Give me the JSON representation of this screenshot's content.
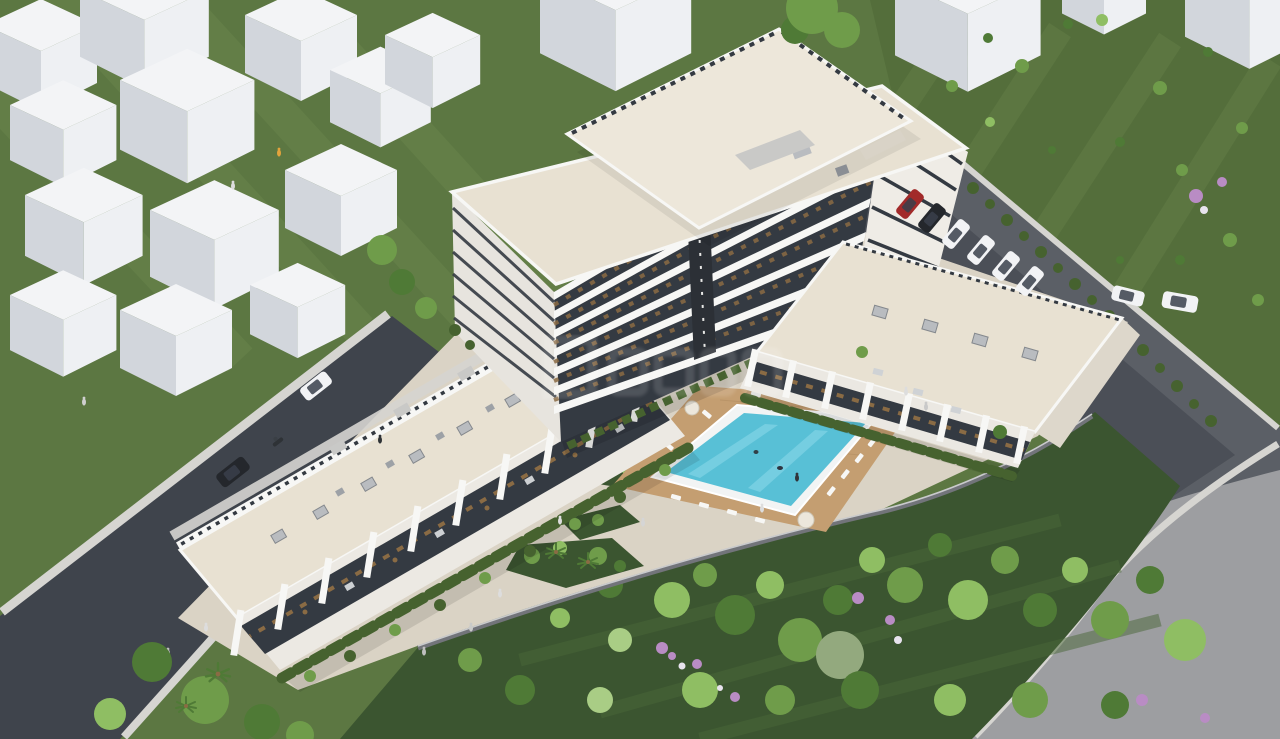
{
  "page": {
    "title": "Aerial 3D architectural rendering of a residential complex"
  },
  "palette": {
    "grass": "#5C7742",
    "grassStripe": "#6E8A50",
    "field": "#546E3B",
    "fieldStripe": "#67814A",
    "garden": "#3B5530",
    "gardenRow": "#4A6838",
    "treeA": "#4F7A36",
    "treeB": "#6F9C4A",
    "treeC": "#8FBE63",
    "treeD": "#A9CD85",
    "treeSage": "#93A97E",
    "hedge": "#46622F",
    "roadDark": "#3F444C",
    "roadMid": "#5B5F66",
    "roadLight": "#9D9EA1",
    "parking": "#4B4F57",
    "sidewalk": "#D6D5D1",
    "plaza": "#DAD3C5",
    "pathLight": "#E6E3DA",
    "roofBeige": "#E8E1D2",
    "canopy": "#EDE7DA",
    "white": "#F7F7F5",
    "facadeLight": "#EFECE6",
    "facadeSide": "#E7E4DE",
    "glass": "#343A42",
    "wood": "#8A6B44",
    "deck": "#C49E71",
    "water": "#58C0D6",
    "waterLight": "#8EDAEA",
    "rim": "#F2F4F4",
    "wallGray": "#72747A",
    "purple": "#B98CC4",
    "flowerWhite": "#E8E3EE",
    "skylight": "#B9BCC0",
    "cubeTop": "#F3F4F6",
    "cubeLeft": "#D2D6DC",
    "cubeRight": "#EEF0F3",
    "carRed": "#A22A2A",
    "carDark": "#24272C",
    "carWhite": "#F2F3F5",
    "figure": "#DADADA",
    "figureOrange": "#E2A33C"
  },
  "labels": {
    "scene": "Aerial render: apartment tower with terraced units, pool and garden",
    "lawn": "Lawn with white massing blocks",
    "context_blocks": "White context massing blocks",
    "field": "Grass field with shrubs",
    "left_road": "Asphalt street (left)",
    "right_road": "Perimeter road (right)",
    "parking": "Parking area behind buildings",
    "plaza": "Paved courtyard and walkways",
    "garden": "Landscaped garden with trees",
    "pool": "Swimming pool",
    "pool_deck": "Wooden pool deck with sun loungers",
    "terraced_row": "Terraced row of units with roof deck",
    "main_tower": "Main apartment tower",
    "rooftop_canopy": "Rooftop canopy slab",
    "right_wing": "Two-storey wing facing the pool",
    "parked_cars": "Parked cars",
    "moving_cars": "Cars driving on road",
    "pedestrians": "People",
    "watermark": "Faint watermark logo"
  },
  "inventory": {
    "tower_floor_bands": 7,
    "terraced_unit_piers": 10,
    "parked_cars_row": 6,
    "street_parked_cars": 2,
    "moving_cars": 2,
    "white_context_blocks": 17,
    "swimming_pools": 1
  },
  "watermark": {
    "present": true,
    "style": "faint white logo glyphs"
  }
}
